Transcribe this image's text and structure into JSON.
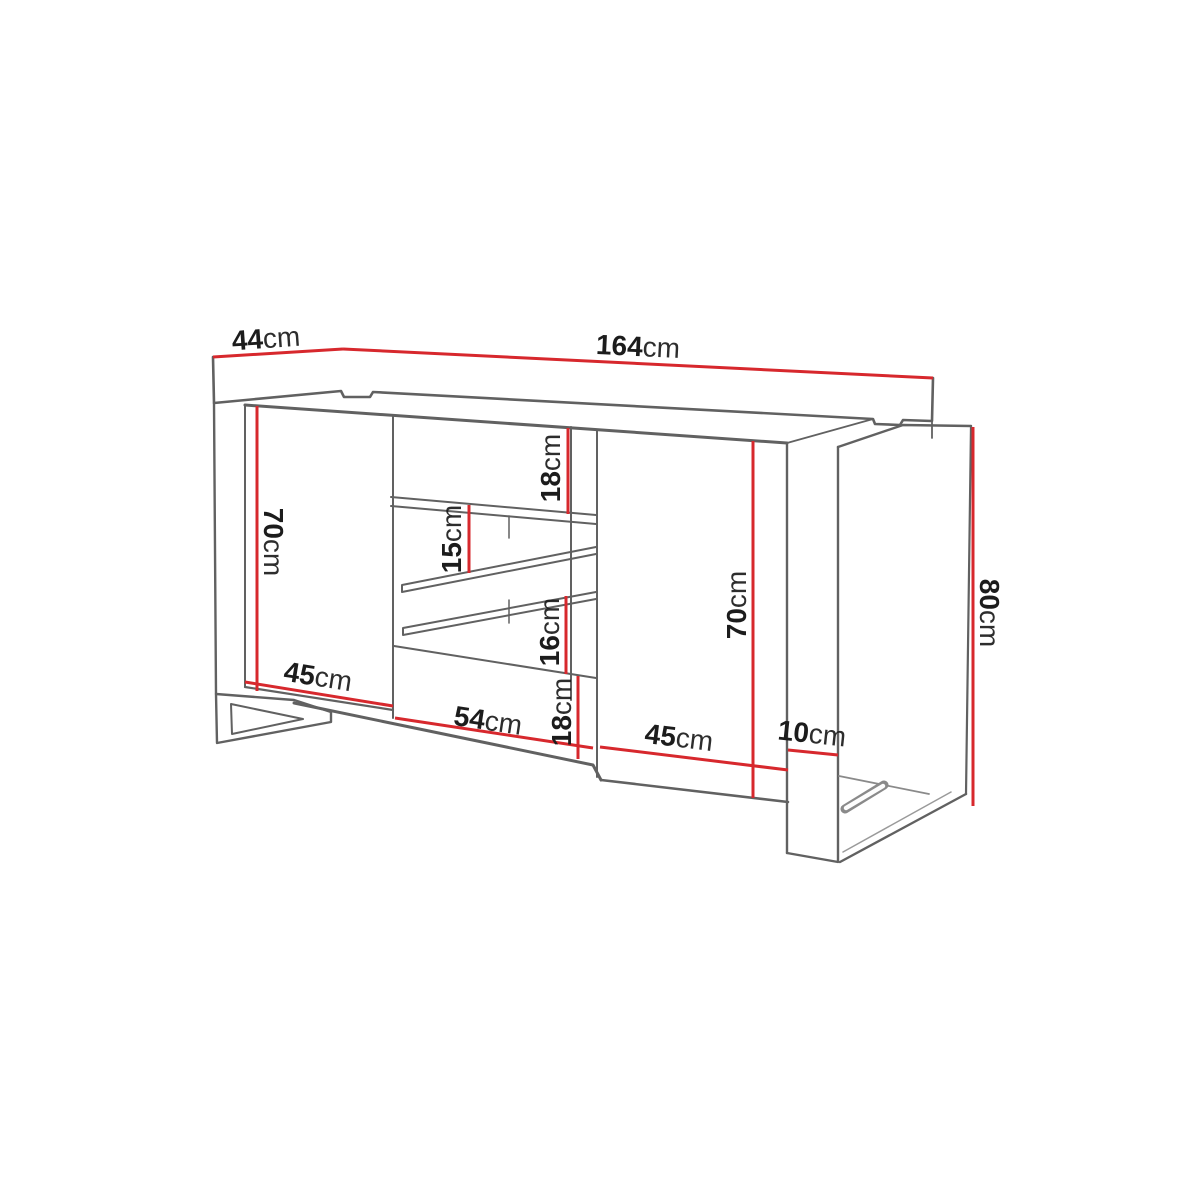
{
  "page": {
    "description": "Technical line drawing (perspective view) of a two-door sideboard cabinet with a central column of two drawers and two open shelf compartments, standing on a left sled leg and a right panel leg, annotated with red dimension lines"
  },
  "colors": {
    "background": "#ffffff",
    "dimension_line": "#d7282d",
    "outline": "#616161",
    "label_text": "#1c1c1c"
  },
  "dimensions": {
    "depth": {
      "value": "44",
      "unit": "cm"
    },
    "width": {
      "value": "164",
      "unit": "cm"
    },
    "total_height": {
      "value": "80",
      "unit": "cm"
    },
    "body_height_left": {
      "value": "70",
      "unit": "cm"
    },
    "body_height_right": {
      "value": "70",
      "unit": "cm"
    },
    "top_drawer_height": {
      "value": "18",
      "unit": "cm"
    },
    "upper_shelf_gap": {
      "value": "15",
      "unit": "cm"
    },
    "lower_shelf_gap": {
      "value": "16",
      "unit": "cm"
    },
    "bottom_drawer_height": {
      "value": "18",
      "unit": "cm"
    },
    "left_door_width": {
      "value": "45",
      "unit": "cm"
    },
    "middle_section_width": {
      "value": "54",
      "unit": "cm"
    },
    "right_door_width": {
      "value": "45",
      "unit": "cm"
    },
    "leg_panel_width": {
      "value": "10",
      "unit": "cm"
    }
  }
}
